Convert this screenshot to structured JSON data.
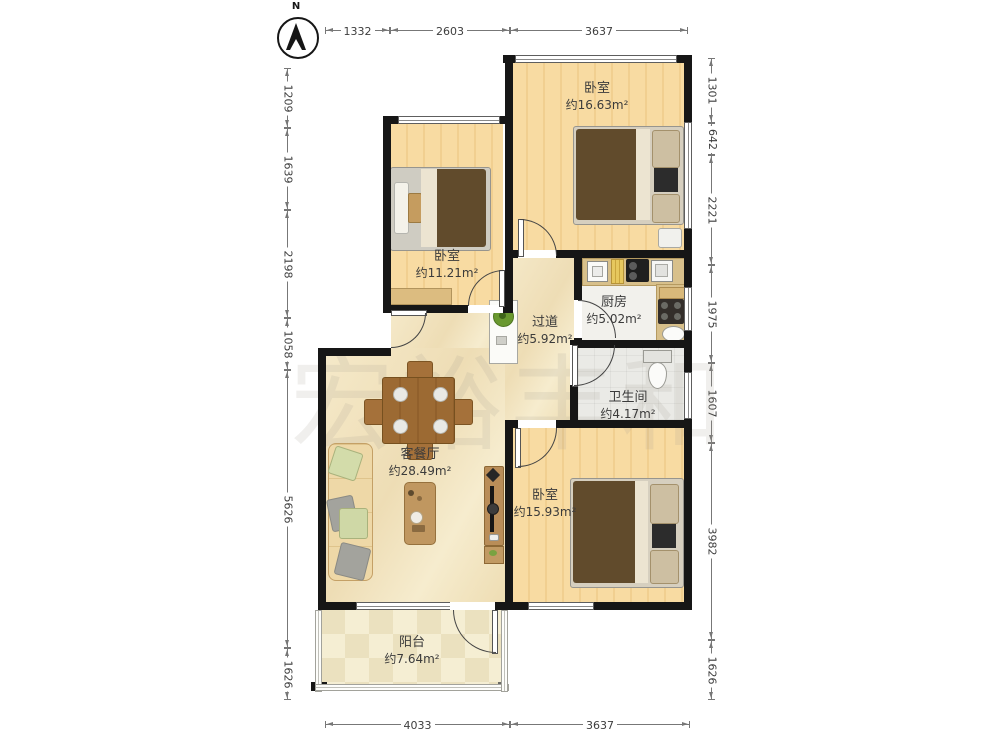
{
  "compass": {
    "label": "N"
  },
  "watermark": {
    "text": "宏裕丰和"
  },
  "rooms": {
    "bedroom_top_right": {
      "name": "卧室",
      "area": "约16.63m²"
    },
    "bedroom_left": {
      "name": "卧室",
      "area": "约11.21m²"
    },
    "kitchen": {
      "name": "厨房",
      "area": "约5.02m²"
    },
    "hallway": {
      "name": "过道",
      "area": "约5.92m²"
    },
    "bathroom": {
      "name": "卫生间",
      "area": "约4.17m²"
    },
    "living_dining": {
      "name": "客餐厅",
      "area": "约28.49m²"
    },
    "bedroom_bottom_right": {
      "name": "卧室",
      "area": "约15.93m²"
    },
    "balcony": {
      "name": "阳台",
      "area": "约7.64m²"
    }
  },
  "dimensions": {
    "top": [
      "1332",
      "2603",
      "3637"
    ],
    "bottom": [
      "4033",
      "3637"
    ],
    "left": [
      "1209",
      "1639",
      "2198",
      "1058",
      "5626",
      "1626"
    ],
    "right": [
      "1301",
      "642",
      "2221",
      "1975",
      "1607",
      "3982",
      "1626"
    ]
  },
  "colors": {
    "wall": "#161616",
    "wood_floor": "#f6d89e",
    "living_floor": "#f2e4c0",
    "counter": "#d8c08b"
  }
}
